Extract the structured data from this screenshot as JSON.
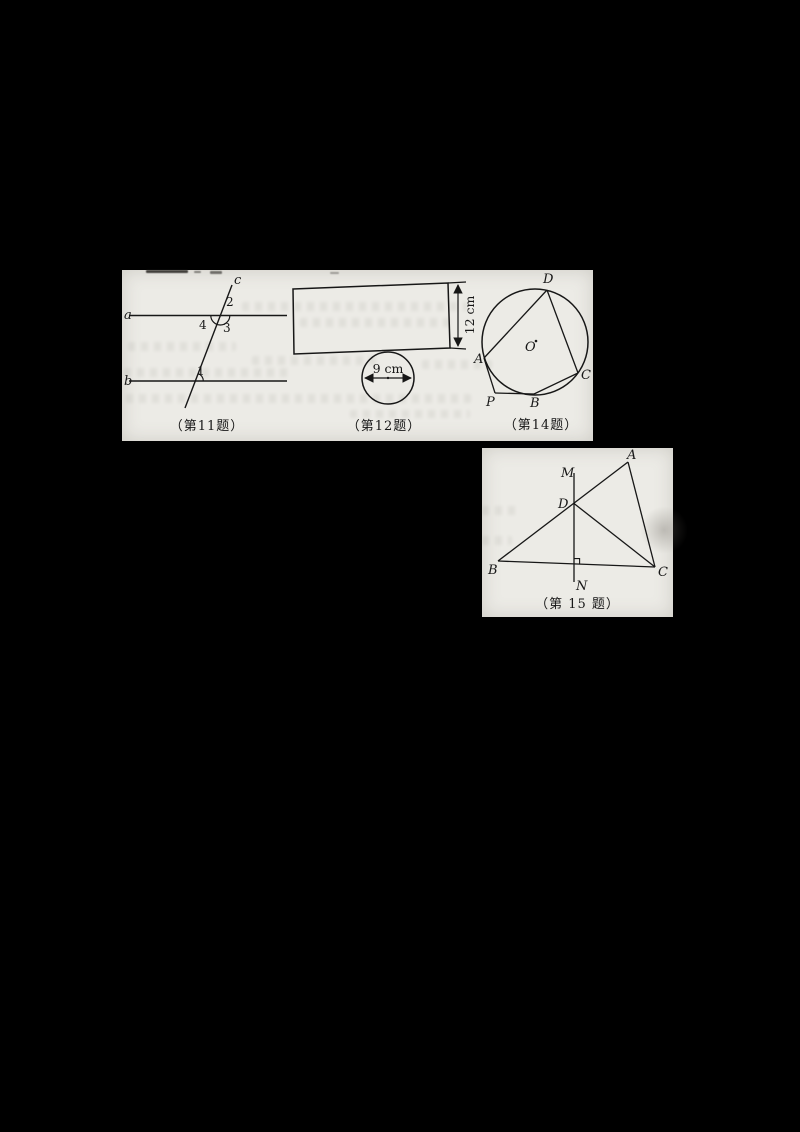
{
  "page": {
    "background_color": "#000000",
    "paper_color": "#ecebe6",
    "ink_color": "#171717"
  },
  "fig11": {
    "caption": "（第11题）",
    "line_a_label": "a",
    "line_b_label": "b",
    "line_c_label": "c",
    "angle_1": "1",
    "angle_2": "2",
    "angle_3": "3",
    "angle_4": "4"
  },
  "fig12": {
    "caption": "（第12题）",
    "height_label": "12 cm",
    "diameter_label": "9 cm"
  },
  "fig14": {
    "caption": "（第14题）",
    "point_a": "A",
    "point_b": "B",
    "point_c": "C",
    "point_d": "D",
    "point_p": "P",
    "center_label": "O"
  },
  "fig15": {
    "caption": "（第 15 题）",
    "point_a": "A",
    "point_b": "B",
    "point_c": "C",
    "point_d": "D",
    "point_m": "M",
    "point_n": "N"
  }
}
